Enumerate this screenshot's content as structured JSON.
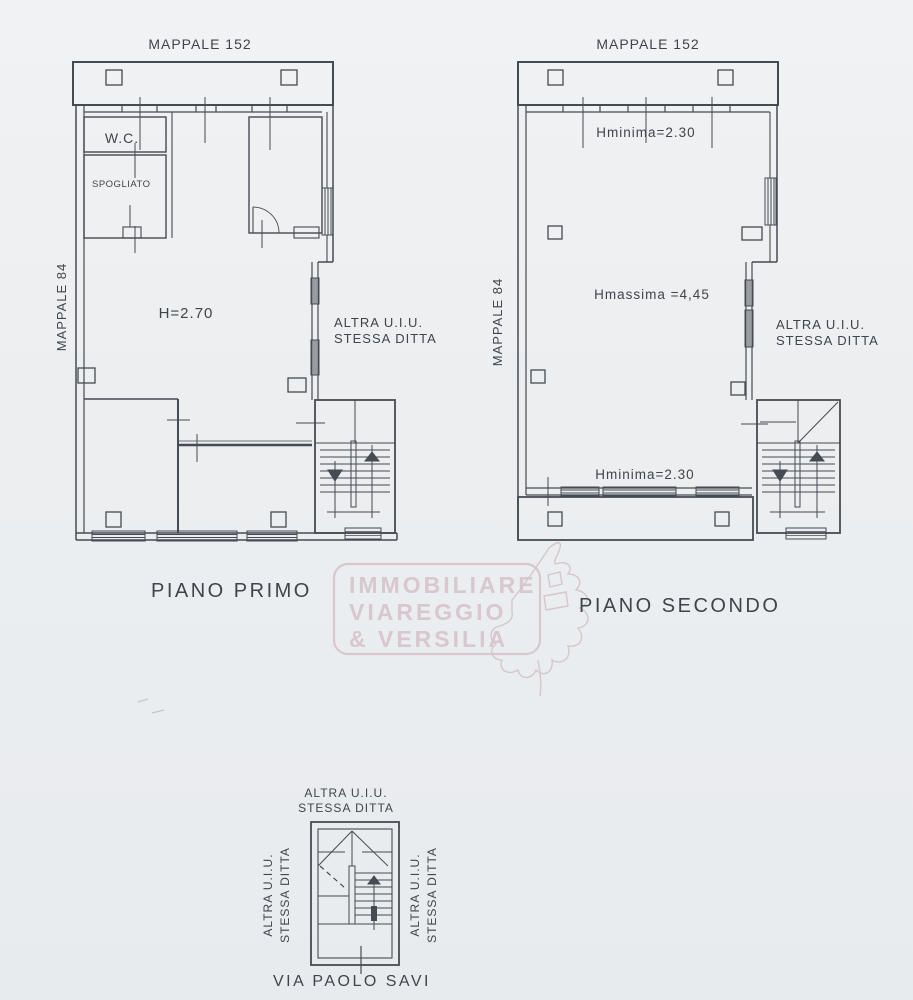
{
  "plan_first": {
    "title": "MAPPALE 152",
    "side_label": "MAPPALE 84",
    "wc": "W.C.",
    "spogliato": "SPOGLIATO",
    "height": "H=2.70",
    "right1": "ALTRA U.I.U.",
    "right2": "STESSA DITTA",
    "caption": "PIANO PRIMO"
  },
  "plan_second": {
    "title": "MAPPALE 152",
    "side_label": "MAPPALE 84",
    "hmin_top": "Hminima=2.30",
    "hmax": "Hmassima =4,45",
    "hmin_bottom": "Hminima=2.30",
    "right1": "ALTRA U.I.U.",
    "right2": "STESSA DITTA",
    "caption": "PIANO SECONDO"
  },
  "stairwell": {
    "top1": "ALTRA U.I.U.",
    "top2": "STESSA DITTA",
    "left1": "ALTRA U.I.U.",
    "left2": "STESSA DITTA",
    "right1": "ALTRA U.I.U.",
    "right2": "STESSA DITTA",
    "street": "VIA PAOLO SAVI"
  },
  "watermark": {
    "line1": "IMMOBILIARE",
    "line2": "VIAREGGIO",
    "line3": "& VERSILIA"
  },
  "colors": {
    "ink": "#454b52",
    "watermark": "#d8c7cd",
    "paper": "#edeff1"
  }
}
